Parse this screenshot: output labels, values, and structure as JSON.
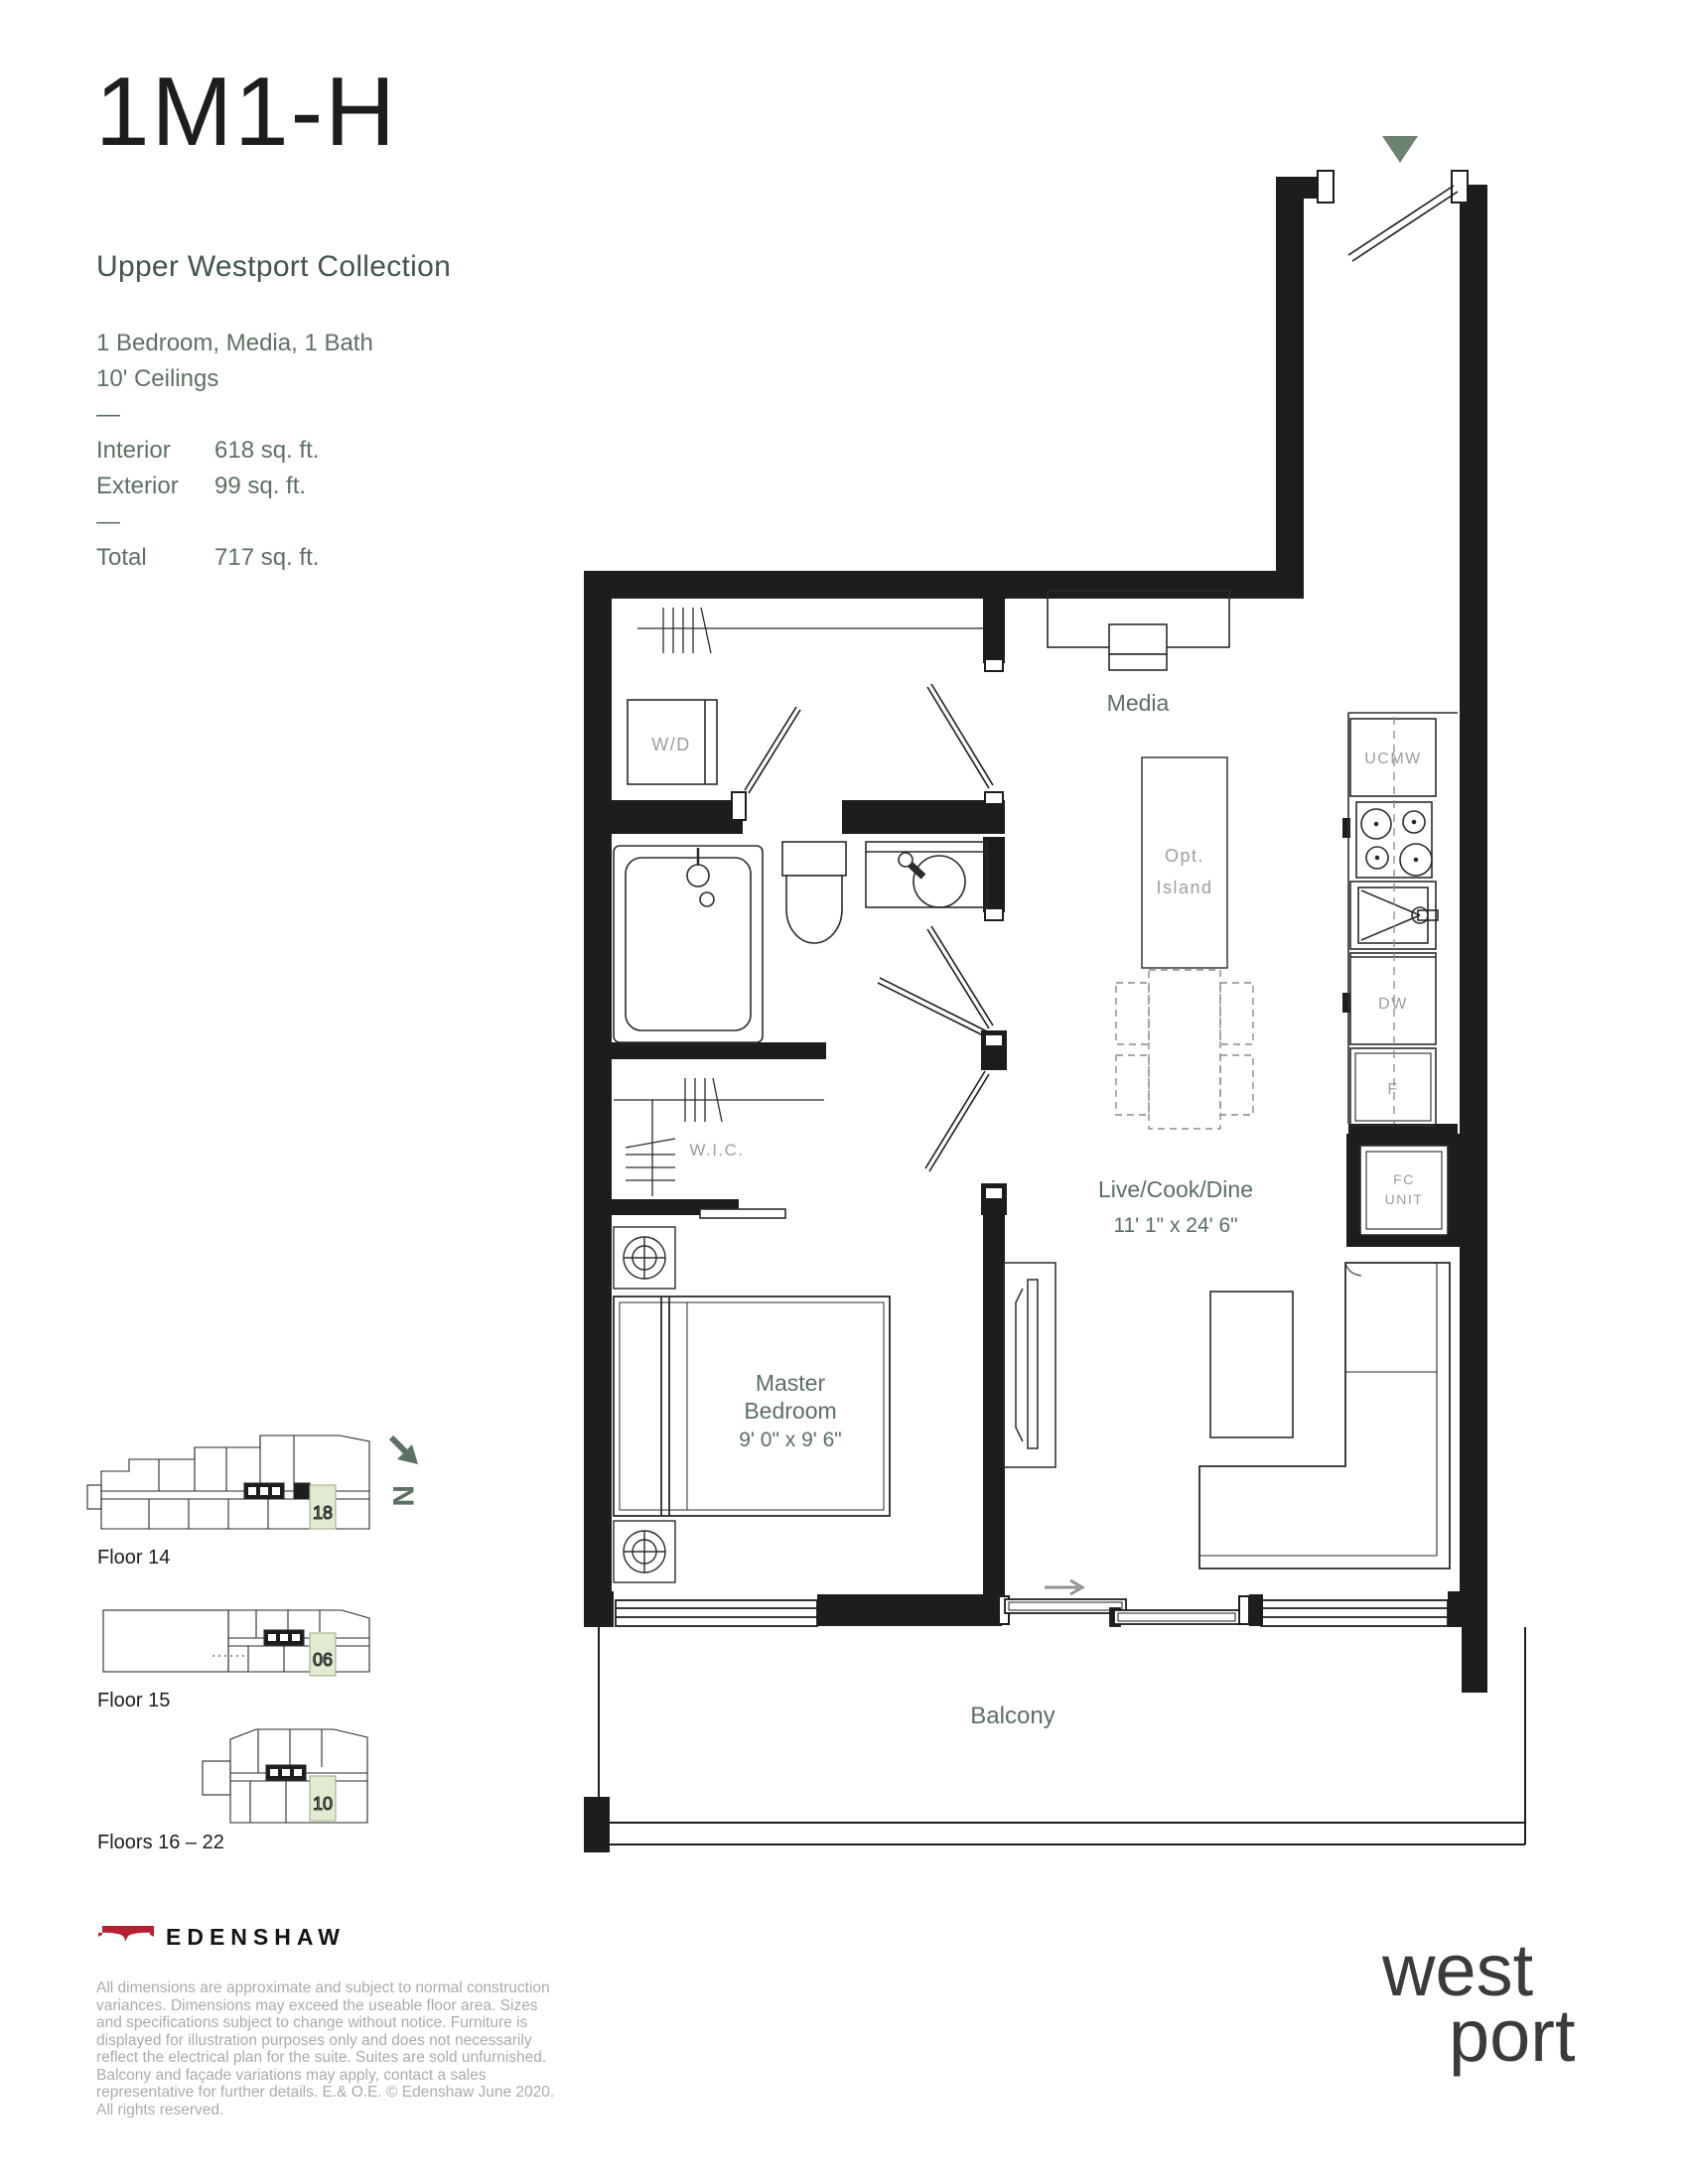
{
  "header": {
    "title": "1M1-H",
    "collection": "Upper Westport Collection",
    "config_line1": "1 Bedroom, Media, 1 Bath",
    "config_line2": "10' Ceilings",
    "dash": "—",
    "specs": [
      {
        "label": "Interior",
        "value": "618 sq. ft."
      },
      {
        "label": "Exterior",
        "value": "99 sq. ft."
      }
    ],
    "total_label": "Total",
    "total_value": "717 sq. ft."
  },
  "floorplan": {
    "rooms": {
      "media": "Media",
      "live_cook_dine": "Live/Cook/Dine",
      "live_cook_dine_dims": "11' 1\" x 24' 6\"",
      "master_line1": "Master",
      "master_line2": "Bedroom",
      "master_dims": "9' 0\" x 9' 6\"",
      "wic": "W.I.C.",
      "balcony": "Balcony"
    },
    "fixtures": {
      "washer_dryer": "W/D",
      "microwave": "UCMW",
      "dishwasher": "DW",
      "fridge": "F",
      "fan_coil_line1": "FC",
      "fan_coil_line2": "UNIT",
      "island_line1": "Opt.",
      "island_line2": "Island"
    }
  },
  "keyplans": {
    "north_letter": "N",
    "items": [
      {
        "label": "Floor 14",
        "unit": "18"
      },
      {
        "label": "Floor 15",
        "unit": "06"
      },
      {
        "label": "Floors 16 – 22",
        "unit": "10"
      }
    ]
  },
  "footer": {
    "brand": "EDENSHAW",
    "legal": "All dimensions are approximate and subject to normal construction variances. Dimensions may exceed the useable floor area. Sizes and specifications subject to change without notice. Furniture is displayed for illustration purposes only and does not necessarily reflect the electrical plan for the suite. Suites are sold unfurnished. Balcony and façade variations may apply, contact a sales representative for further details. E.& O.E. © Edenshaw June 2020. All rights reserved.",
    "logo_line1": "west",
    "logo_line2": "port"
  },
  "colors": {
    "wall_black": "#1d1d1d",
    "label_green": "#5b7062",
    "fixture_grey": "#9aa09e",
    "accent_green": "#6e8273",
    "unit_highlight": "#e2ebd2",
    "brand_red": "#b72030",
    "legal_grey": "#a9acac"
  }
}
